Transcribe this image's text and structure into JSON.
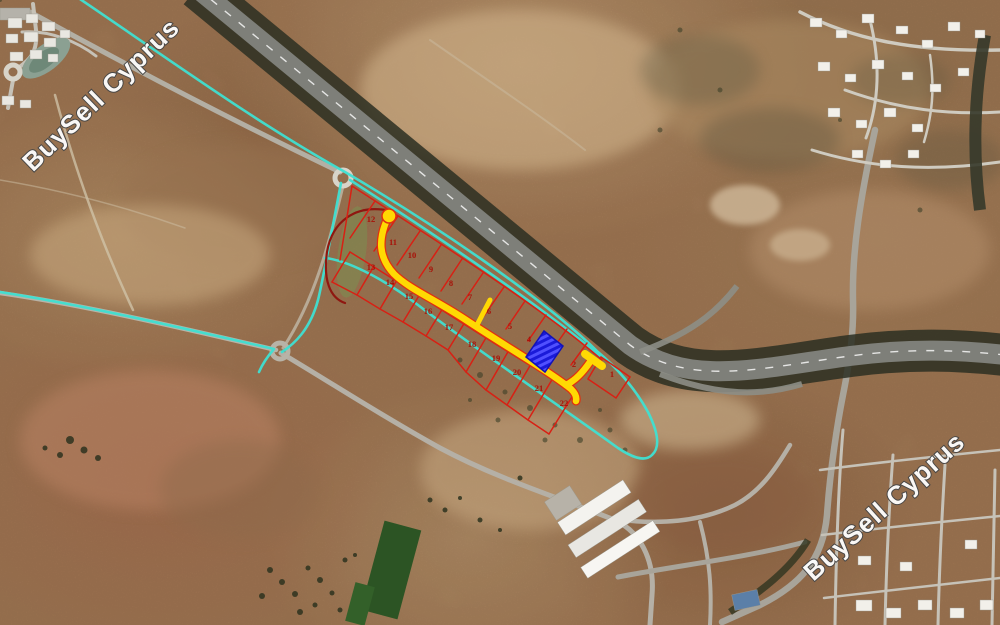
{
  "map": {
    "description": "Satellite aerial photo of land plots for sale beside a motorway, Cyprus",
    "watermarks": [
      {
        "id": "top-left",
        "text": "BuySell Cyprus"
      },
      {
        "id": "bottom-right",
        "text": "BuySell Cyprus"
      }
    ],
    "overlay_colors": {
      "boundary_cyan": "#3fe0d2",
      "plot_line_red": "#d82014",
      "outer_boundary_maroon": "#8f1710",
      "road_yellow": "#ffd903",
      "parcel_blue": "#1a1ad9",
      "plot_number_red": "#a81108"
    },
    "plot_labels": {
      "upper_row": [
        {
          "label": "12",
          "x": 371,
          "y": 222
        },
        {
          "label": "11",
          "x": 393,
          "y": 245
        },
        {
          "label": "10",
          "x": 412,
          "y": 258
        },
        {
          "label": "9",
          "x": 431,
          "y": 272
        },
        {
          "label": "8",
          "x": 451,
          "y": 286
        },
        {
          "label": "7",
          "x": 470,
          "y": 300
        },
        {
          "label": "6",
          "x": 489,
          "y": 314
        },
        {
          "label": "5",
          "x": 510,
          "y": 329
        },
        {
          "label": "4",
          "x": 529,
          "y": 342
        },
        {
          "label": "2",
          "x": 574,
          "y": 367
        },
        {
          "label": "1",
          "x": 612,
          "y": 377
        }
      ],
      "lower_row": [
        {
          "label": "13",
          "x": 371,
          "y": 270
        },
        {
          "label": "14",
          "x": 390,
          "y": 285
        },
        {
          "label": "15",
          "x": 409,
          "y": 299
        },
        {
          "label": "16",
          "x": 428,
          "y": 314
        },
        {
          "label": "17",
          "x": 449,
          "y": 330
        },
        {
          "label": "18",
          "x": 472,
          "y": 347
        },
        {
          "label": "19",
          "x": 496,
          "y": 361
        },
        {
          "label": "20",
          "x": 517,
          "y": 375
        },
        {
          "label": "21",
          "x": 539,
          "y": 391
        },
        {
          "label": "22",
          "x": 564,
          "y": 406
        }
      ]
    },
    "highlighted_parcel": {
      "style": "blue-diagonal-hatch"
    }
  }
}
